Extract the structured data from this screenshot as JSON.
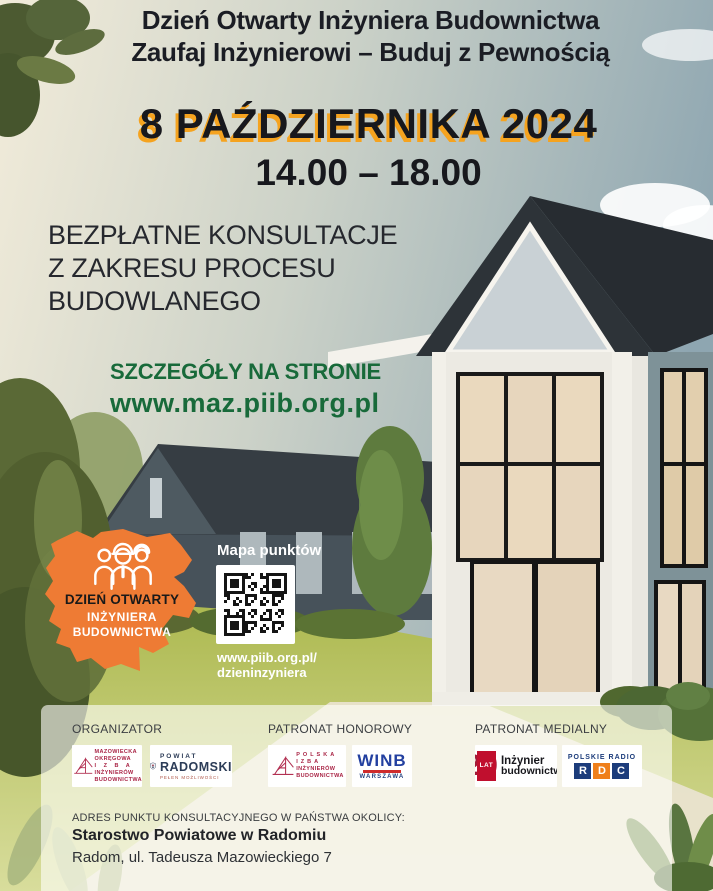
{
  "header": {
    "line1": "Dzień Otwarty Inżyniera Budownictwa",
    "line2": "Zaufaj Inżynierowi – Buduj z Pewnością"
  },
  "event": {
    "date": "8 PAŹDZIERNIKA 2024",
    "time": "14.00 – 18.00"
  },
  "offer": {
    "line1": "BEZPŁATNE KONSULTACJE",
    "line2": "Z ZAKRESU PROCESU",
    "line3": "BUDOWLANEGO"
  },
  "details": {
    "label": "SZCZEGÓŁY NA STRONIE",
    "url": "www.maz.piib.org.pl"
  },
  "badge": {
    "line1": "DZIEŃ OTWARTY",
    "line2": "INŻYNIERA",
    "line3": "BUDOWNICTWA"
  },
  "qr": {
    "title": "Mapa punktów",
    "link_line1": "www.piib.org.pl/",
    "link_line2": "dzieninzyniera"
  },
  "footer": {
    "organizer_label": "ORGANIZATOR",
    "honorary_label": "PATRONAT HONOROWY",
    "media_label": "PATRONAT MEDIALNY",
    "logos": {
      "moiib": {
        "lines": [
          "MAZOWIECKA",
          "OKRĘGOWA",
          "I Z B A",
          "INŻYNIERÓW",
          "BUDOWNICTWA"
        ]
      },
      "powiat": {
        "top": "POWIAT",
        "name": "RADOMSKI",
        "tagline": "PEŁEN MOŻLIWOŚCI"
      },
      "piib": {
        "lines": [
          "POLSKA",
          "IZBA",
          "INŻYNIERÓW",
          "BUDOWNICTWA"
        ]
      },
      "winb": {
        "name": "WINB",
        "city": "WARSZAWA"
      },
      "inzynier": {
        "number": "20",
        "lat": "LAT",
        "line1": "Inżynier",
        "line2": "budownictwa"
      },
      "rdc": {
        "top": "POLSKIE RADIO",
        "letters": [
          "R",
          "D",
          "C"
        ]
      }
    },
    "address_label": "ADRES PUNKTU KONSULTACYJNEGO W PAŃSTWA OKOLICY:",
    "address_name": "Starostwo Powiatowe w Radomiu",
    "address_street": "Radom, ul. Tadeusza Mazowieckiego 7"
  },
  "colors": {
    "accent_orange": "#ee7b34",
    "date_shadow": "#f5a31f",
    "link_green": "#186a3a",
    "text_dark": "#1b1d24",
    "winb_blue": "#2340a0",
    "rdc_navy": "#1c3c7b",
    "rdc_orange": "#ef7f1a",
    "brand_maroon": "#a92445"
  }
}
